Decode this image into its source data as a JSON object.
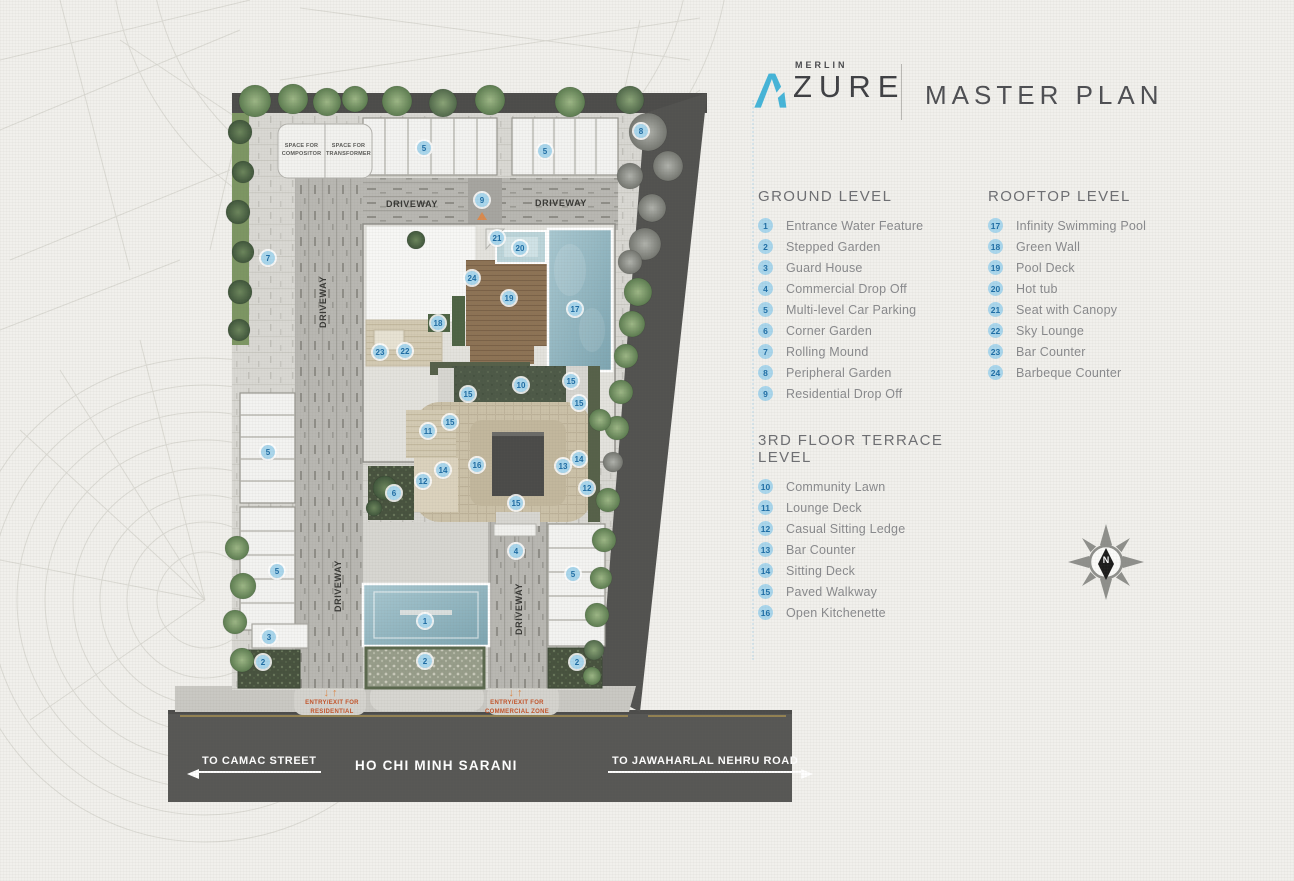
{
  "colors": {
    "background": "#f1f0ec",
    "accent_blue": "#45b5d9",
    "marker_fill": "#a9d6ec",
    "marker_text": "#1e6ea6",
    "road_dark": "#575755",
    "pool_blue": "#8fb4c0",
    "entry_text_red": "#c4542a"
  },
  "header": {
    "brand_initial": "A",
    "brand_small": "MERLIN",
    "brand_large": "ZURE",
    "title": "MASTER PLAN"
  },
  "legend": {
    "ground": {
      "title": "GROUND LEVEL",
      "items": [
        {
          "num": "1",
          "label": "Entrance Water Feature"
        },
        {
          "num": "2",
          "label": "Stepped Garden"
        },
        {
          "num": "3",
          "label": "Guard House"
        },
        {
          "num": "4",
          "label": "Commercial Drop Off"
        },
        {
          "num": "5",
          "label": "Multi-level Car Parking"
        },
        {
          "num": "6",
          "label": "Corner Garden"
        },
        {
          "num": "7",
          "label": "Rolling Mound"
        },
        {
          "num": "8",
          "label": "Peripheral Garden"
        },
        {
          "num": "9",
          "label": "Residential Drop Off"
        }
      ]
    },
    "rooftop": {
      "title": "ROOFTOP LEVEL",
      "items": [
        {
          "num": "17",
          "label": "Infinity Swimming Pool"
        },
        {
          "num": "18",
          "label": "Green Wall"
        },
        {
          "num": "19",
          "label": "Pool Deck"
        },
        {
          "num": "20",
          "label": "Hot tub"
        },
        {
          "num": "21",
          "label": "Seat with Canopy"
        },
        {
          "num": "22",
          "label": "Sky Lounge"
        },
        {
          "num": "23",
          "label": "Bar Counter"
        },
        {
          "num": "24",
          "label": "Barbeque Counter"
        }
      ]
    },
    "terrace": {
      "title": "3RD FLOOR TERRACE LEVEL",
      "items": [
        {
          "num": "10",
          "label": "Community Lawn"
        },
        {
          "num": "11",
          "label": "Lounge Deck"
        },
        {
          "num": "12",
          "label": "Casual Sitting Ledge"
        },
        {
          "num": "13",
          "label": "Bar Counter"
        },
        {
          "num": "14",
          "label": "Sitting Deck"
        },
        {
          "num": "15",
          "label": "Paved Walkway"
        },
        {
          "num": "16",
          "label": "Open Kitchenette"
        }
      ]
    }
  },
  "plan": {
    "markers": [
      {
        "n": "1",
        "x": 425,
        "y": 621
      },
      {
        "n": "2",
        "x": 263,
        "y": 662
      },
      {
        "n": "2",
        "x": 425,
        "y": 661
      },
      {
        "n": "2",
        "x": 577,
        "y": 662
      },
      {
        "n": "3",
        "x": 269,
        "y": 637
      },
      {
        "n": "4",
        "x": 516,
        "y": 551
      },
      {
        "n": "5",
        "x": 424,
        "y": 148
      },
      {
        "n": "5",
        "x": 545,
        "y": 151
      },
      {
        "n": "5",
        "x": 268,
        "y": 452
      },
      {
        "n": "5",
        "x": 277,
        "y": 571
      },
      {
        "n": "5",
        "x": 573,
        "y": 574
      },
      {
        "n": "6",
        "x": 394,
        "y": 493
      },
      {
        "n": "7",
        "x": 268,
        "y": 258
      },
      {
        "n": "8",
        "x": 641,
        "y": 131
      },
      {
        "n": "9",
        "x": 482,
        "y": 200
      },
      {
        "n": "10",
        "x": 521,
        "y": 385
      },
      {
        "n": "11",
        "x": 428,
        "y": 431
      },
      {
        "n": "12",
        "x": 423,
        "y": 481
      },
      {
        "n": "12",
        "x": 587,
        "y": 488
      },
      {
        "n": "13",
        "x": 563,
        "y": 466
      },
      {
        "n": "14",
        "x": 443,
        "y": 470
      },
      {
        "n": "14",
        "x": 579,
        "y": 459
      },
      {
        "n": "15",
        "x": 468,
        "y": 394
      },
      {
        "n": "15",
        "x": 571,
        "y": 381
      },
      {
        "n": "15",
        "x": 579,
        "y": 403
      },
      {
        "n": "15",
        "x": 450,
        "y": 422
      },
      {
        "n": "15",
        "x": 516,
        "y": 503
      },
      {
        "n": "16",
        "x": 477,
        "y": 465
      },
      {
        "n": "17",
        "x": 575,
        "y": 309
      },
      {
        "n": "18",
        "x": 438,
        "y": 323
      },
      {
        "n": "19",
        "x": 509,
        "y": 298
      },
      {
        "n": "20",
        "x": 520,
        "y": 248
      },
      {
        "n": "21",
        "x": 497,
        "y": 238
      },
      {
        "n": "22",
        "x": 405,
        "y": 351
      },
      {
        "n": "23",
        "x": 380,
        "y": 352
      },
      {
        "n": "24",
        "x": 472,
        "y": 278
      }
    ],
    "driveway_labels": [
      {
        "text": "DRIVEWAY",
        "x": 412,
        "y": 204,
        "rot": 0
      },
      {
        "text": "DRIVEWAY",
        "x": 561,
        "y": 203,
        "rot": 0
      },
      {
        "text": "DRIVEWAY",
        "x": 323,
        "y": 302,
        "rot": -90
      },
      {
        "text": "DRIVEWAY",
        "x": 338,
        "y": 586,
        "rot": -90
      },
      {
        "text": "DRIVEWAY",
        "x": 519,
        "y": 609,
        "rot": -90
      }
    ],
    "utility_boxes": [
      {
        "label": "SPACE FOR COMPOSITOR"
      },
      {
        "label": "SPACE FOR TRANSFORMER"
      }
    ],
    "entries": [
      {
        "line1": "ENTRY/EXIT FOR",
        "line2": "RESIDENTIAL",
        "x": 332,
        "y": 688
      },
      {
        "line1": "ENTRY/EXIT FOR",
        "line2": "COMMERCIAL ZONE",
        "x": 517,
        "y": 688
      }
    ]
  },
  "road": {
    "name": "HO CHI MINH SARANI",
    "left_direction": "TO CAMAC STREET",
    "right_direction": "TO JAWAHARLAL NEHRU ROAD"
  },
  "compass": {
    "north_label": "N"
  }
}
